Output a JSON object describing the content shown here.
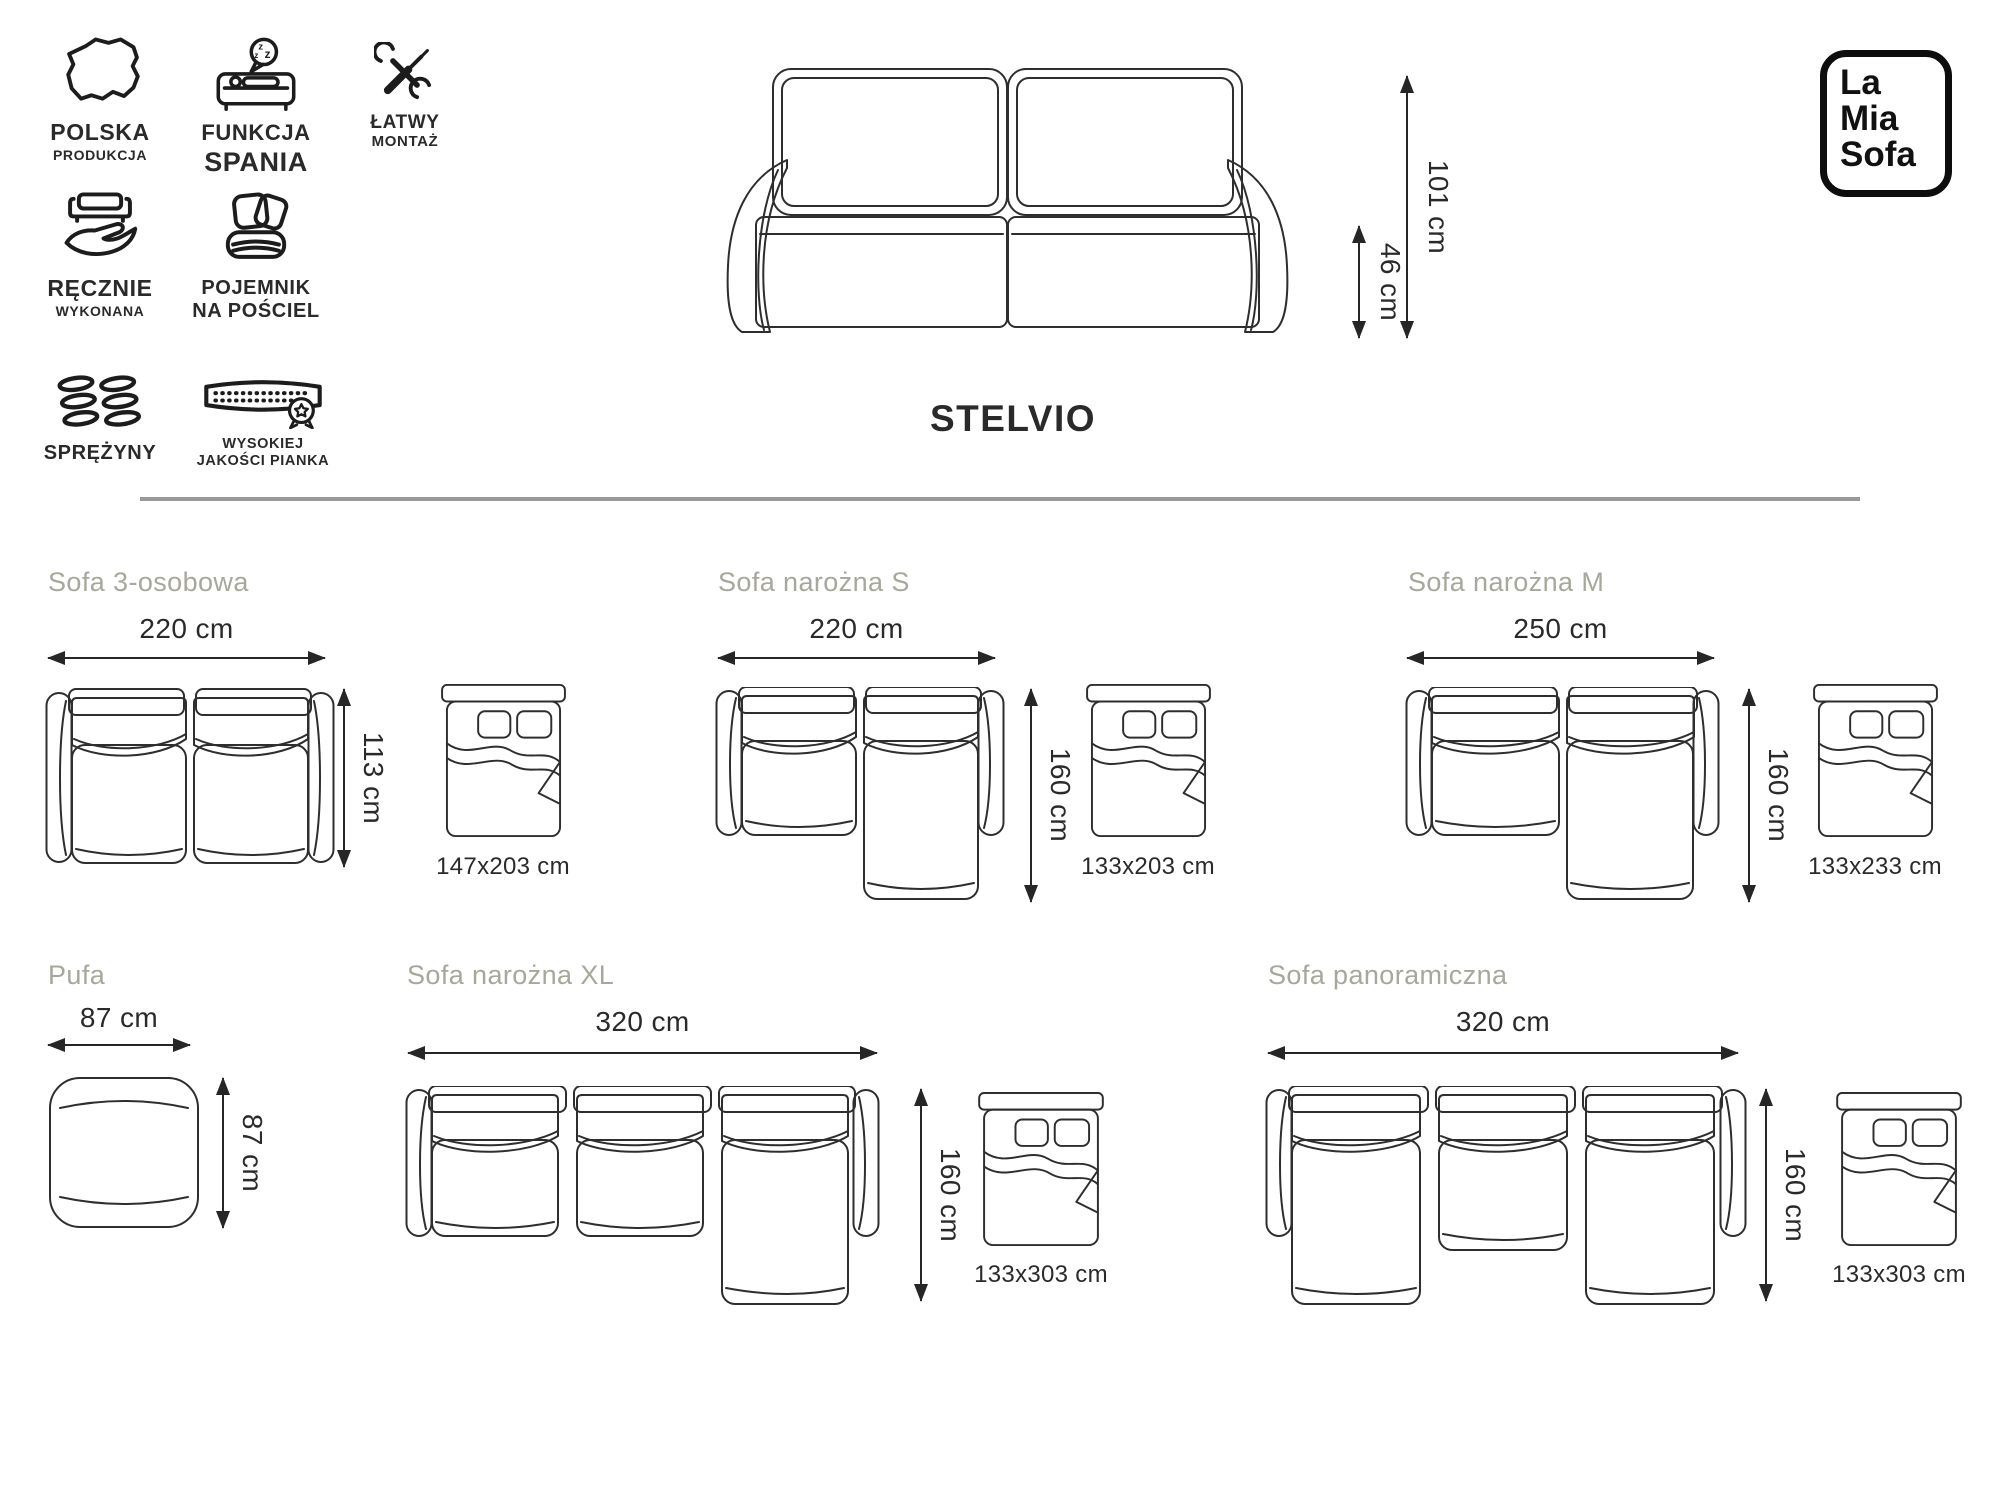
{
  "brand": {
    "line1": "La",
    "line2": "Mia",
    "line3": "Sofa"
  },
  "hero": {
    "product_name": "STELVIO",
    "total_height": "101 cm",
    "seat_height": "46 cm"
  },
  "features": [
    {
      "icon": "poland-map-icon",
      "line1": "POLSKA",
      "line2": "PRODUKCJA"
    },
    {
      "icon": "sleep-function-icon",
      "line1": "FUNKCJA",
      "line2": "SPANIA"
    },
    {
      "icon": "tools-icon",
      "line1": "ŁATWY",
      "line2": "MONTAŻ"
    },
    {
      "icon": "handmade-icon",
      "line1": "RĘCZNIE",
      "line2": "WYKONANA"
    },
    {
      "icon": "bedding-storage-icon",
      "line1": "POJEMNIK",
      "line2": "NA POŚCIEL"
    },
    {
      "icon": "springs-icon",
      "line1": "SPRĘŻYNY"
    },
    {
      "icon": "foam-quality-icon",
      "line1": "WYSOKIEJ",
      "line2": "JAKOŚCI PIANKA"
    }
  ],
  "variants": [
    {
      "id": "sofa-3-osobowa",
      "title": "Sofa 3-osobowa",
      "width": "220 cm",
      "depth": "113 cm",
      "bed": "147x203 cm"
    },
    {
      "id": "sofa-narozna-s",
      "title": "Sofa narożna S",
      "width": "220 cm",
      "depth": "160 cm",
      "bed": "133x203 cm"
    },
    {
      "id": "sofa-narozna-m",
      "title": "Sofa narożna M",
      "width": "250 cm",
      "depth": "160 cm",
      "bed": "133x233 cm"
    },
    {
      "id": "pufa",
      "title": "Pufa",
      "width": "87 cm",
      "depth": "87 cm"
    },
    {
      "id": "sofa-narozna-xl",
      "title": "Sofa narożna XL",
      "width": "320 cm",
      "depth": "160 cm",
      "bed": "133x303 cm"
    },
    {
      "id": "sofa-panoramiczna",
      "title": "Sofa panoramiczna",
      "width": "320 cm",
      "depth": "160 cm",
      "bed": "133x303 cm"
    }
  ],
  "colors": {
    "line_art": "#2e2e2e",
    "section_title": "#a7a79b",
    "divider": "#999999",
    "text": "#2a2a2a",
    "background": "#ffffff"
  }
}
